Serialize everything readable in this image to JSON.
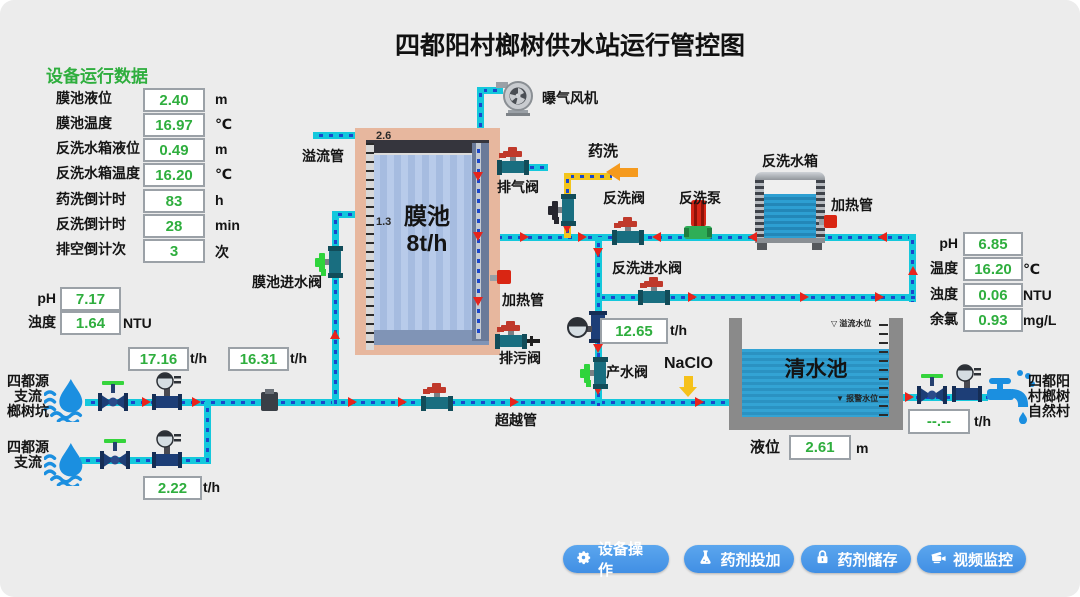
{
  "title": "四都阳村榔树供水站运行管控图",
  "device_panel": {
    "header": "设备运行数据",
    "rows": [
      {
        "label": "膜池液位",
        "value": "2.40",
        "unit": "m"
      },
      {
        "label": "膜池温度",
        "value": "16.97",
        "unit": "℃"
      },
      {
        "label": "反洗水箱液位",
        "value": "0.49",
        "unit": "m"
      },
      {
        "label": "反洗水箱温度",
        "value": "16.20",
        "unit": "℃"
      },
      {
        "label": "药洗倒计时",
        "value": "83",
        "unit": "h"
      },
      {
        "label": "反洗倒计时",
        "value": "28",
        "unit": "min"
      },
      {
        "label": "排空倒计次",
        "value": "3",
        "unit": "次"
      }
    ]
  },
  "inlet_quality": {
    "rows": [
      {
        "label": "pH",
        "value": "7.17",
        "unit": ""
      },
      {
        "label": "浊度",
        "value": "1.64",
        "unit": "NTU"
      }
    ]
  },
  "outlet_quality": {
    "rows": [
      {
        "label": "pH",
        "value": "6.85",
        "unit": ""
      },
      {
        "label": "温度",
        "value": "16.20",
        "unit": "℃"
      },
      {
        "label": "浊度",
        "value": "0.06",
        "unit": "NTU"
      },
      {
        "label": "余氯",
        "value": "0.93",
        "unit": "mg/L"
      }
    ]
  },
  "flow_meters": {
    "inlet_main": {
      "value": "17.16",
      "unit": "t/h"
    },
    "inlet_total": {
      "value": "16.31",
      "unit": "t/h"
    },
    "tributary": {
      "value": "2.22",
      "unit": "t/h"
    },
    "product": {
      "value": "12.65",
      "unit": "t/h"
    },
    "village_outlet": {
      "value": "--.--",
      "unit": "t/h"
    }
  },
  "sources": {
    "source_1": "四都源\n支流\n榔树坑",
    "source_2": "四都源\n支流"
  },
  "destination": "四都阳\n村榔树\n自然村",
  "membrane_tank": {
    "name": "膜池\n8t/h",
    "scale_top": "2.6",
    "scale_mid": "1.3"
  },
  "clear_pool": {
    "name": "清水池",
    "level_label": "液位",
    "level_value": "2.61",
    "level_unit": "m",
    "overflow_marker": "▽ 溢流水位",
    "alarm_marker": "▼ 报警水位"
  },
  "labels": {
    "overflow_pipe": "溢流管",
    "membrane_inlet_valve": "膜池进水阀",
    "exhaust_valve": "排气阀",
    "chemical_wash": "药洗",
    "backwash_valve": "反洗阀",
    "backwash_pump": "反洗泵",
    "backwash_tank": "反洗水箱",
    "heater_tank": "加热管",
    "heater_membrane": "加热管",
    "backwash_inlet_valve": "反洗进水阀",
    "drain_valve": "排污阀",
    "product_valve": "产水阀",
    "naclo": "NaClO",
    "bypass_pipe": "超越管",
    "aeration_fan": "曝气风机"
  },
  "buttons": [
    {
      "label": "设备操作",
      "icon": "gear-icon"
    },
    {
      "label": "药剂投加",
      "icon": "flask-icon"
    },
    {
      "label": "药剂储存",
      "icon": "lock-icon"
    },
    {
      "label": "视频监控",
      "icon": "camera-icon"
    }
  ],
  "colors": {
    "value_green": "#2fae3e",
    "pipe_cyan": "#14c8dc",
    "pipe_dash": "#1a46cc",
    "chem_yellow": "#f5c11a",
    "button_blue": "#4f9cea",
    "alert_red": "#e8241c"
  }
}
